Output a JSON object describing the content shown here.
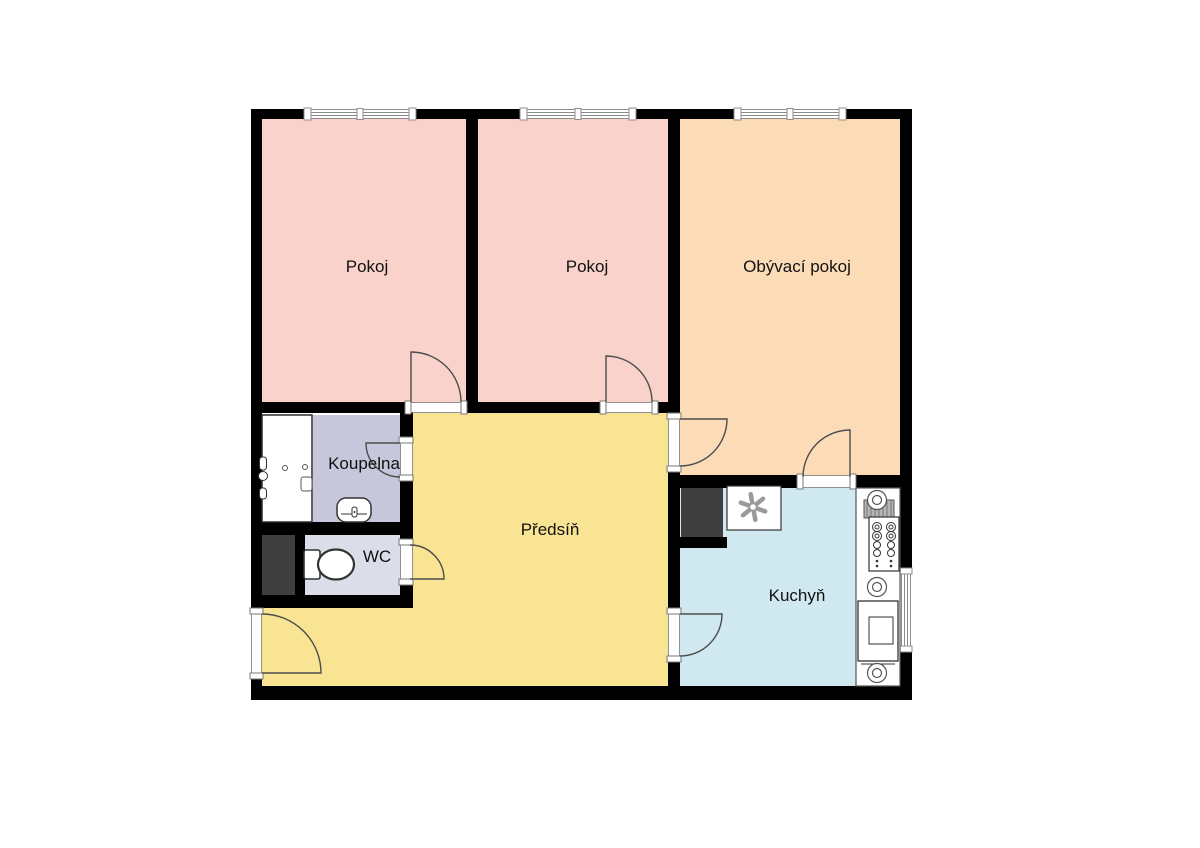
{
  "plan": {
    "type": "apartment-floor-plan",
    "language": "cs",
    "rooms": [
      {
        "id": "pokoj-1",
        "label": "Pokoj"
      },
      {
        "id": "pokoj-2",
        "label": "Pokoj"
      },
      {
        "id": "obyvaci-pokoj",
        "label": "Obývací pokoj"
      },
      {
        "id": "koupelna",
        "label": "Koupelna"
      },
      {
        "id": "wc",
        "label": "WC"
      },
      {
        "id": "predsin",
        "label": "Předsíň"
      },
      {
        "id": "kuchyn",
        "label": "Kuchyň"
      }
    ],
    "colors": {
      "background": "#ffffff",
      "wall": "#000000",
      "pokoj": "#f8d2cb",
      "obyvaci_pokoj": "#fbdcb7",
      "predsin": "#f8e492",
      "kuchyn": "#d0e9f0",
      "koupelna": "#c6c7db",
      "wc": "#dbdde8",
      "shaft": "#3f3f3f",
      "fixture": "#ffffff",
      "door_line": "#4d4d4d",
      "window_line": "#8c8c8c",
      "jamb_line": "#777777",
      "fixture_line": "#333333",
      "fan_line": "#9a9a9a",
      "label_text": "#111111"
    },
    "fixtures": [
      "bathtub",
      "bath-tap",
      "washbasin",
      "toilet",
      "ventilation-fan",
      "service-shaft",
      "kitchen-counter",
      "cooktop-burner",
      "sink-drainer",
      "stove-control-panel",
      "oven"
    ]
  }
}
